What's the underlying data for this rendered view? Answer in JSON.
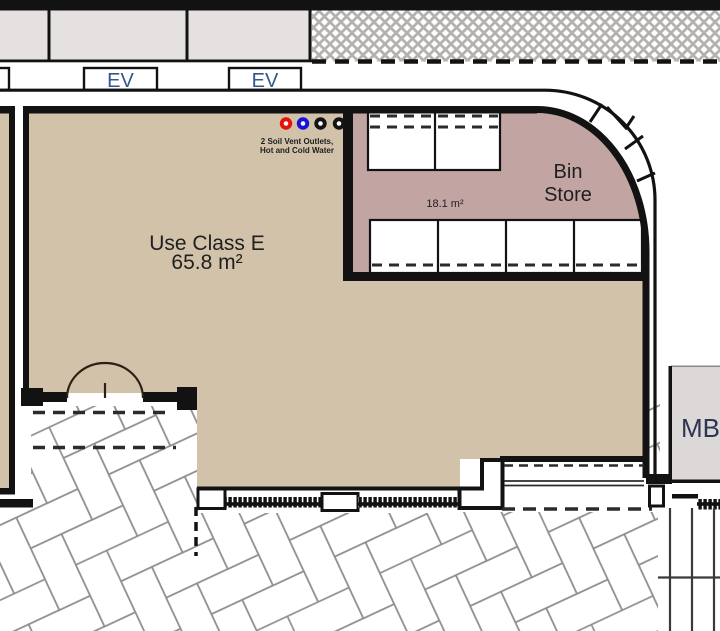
{
  "drawing": {
    "parking": {
      "ev_label": "EV"
    },
    "vent_note": {
      "line1": "2 Soil Vent Outlets,",
      "line2": "Hot and Cold Water"
    },
    "main_room": {
      "use_class": "Use Class E",
      "area": "65.8 m²"
    },
    "bin_store": {
      "label_line1": "Bin",
      "label_line2": "Store",
      "area": "18.1 m²"
    },
    "meter_box": {
      "label": "MB"
    }
  },
  "colors": {
    "room_fill": "#d1c2a9",
    "bin_store_fill": "#c2a4a3",
    "parking_bay_fill": "#e4e1e0",
    "meter_box_fill": "#dbd8d7",
    "ink": "#1f1f1f",
    "ev_text": "#35558f",
    "mb_text": "#2b3650",
    "vent_red": "#e51208",
    "vent_blue": "#1613d8",
    "vent_black": "#141414"
  }
}
